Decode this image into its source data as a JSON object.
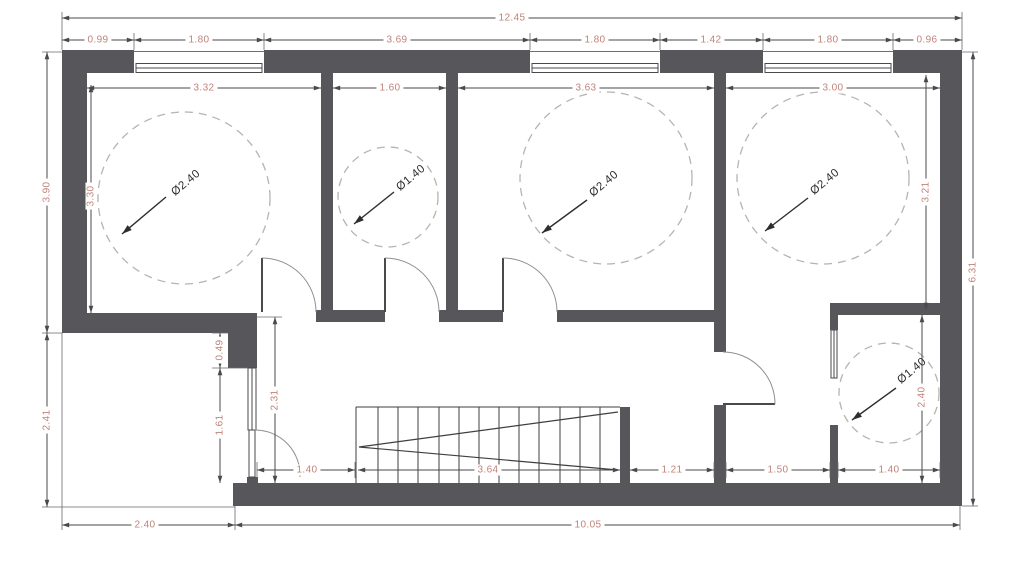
{
  "drawing_type": "architectural-floor-plan",
  "colors": {
    "wall": "#57565a",
    "line": "#4a4a4d",
    "dim_text": "#c0837a",
    "circle_dash": "#b7b3b0",
    "door_arc": "#8f8f8f",
    "background": "#ffffff"
  },
  "dims": {
    "overall_width": "12.45",
    "top": [
      "0.99",
      "1.80",
      "3.69",
      "1.80",
      "1.42",
      "1.80",
      "0.96"
    ],
    "left_upper": "3.90",
    "left_lower": "2.41",
    "right_height": "6.31",
    "bottom_left": "2.40",
    "bottom_right": "10.05",
    "room1_w": "3.32",
    "room1_h": "3.30",
    "room2_w": "1.60",
    "room3_w": "3.63",
    "room4_w": "3.00",
    "room4_h": "3.21",
    "entry_upper": "0.49",
    "entry_window": "1.61",
    "entry_clear": "2.31",
    "hall_left": "1.40",
    "stairs_run": "3.64",
    "hall_mid": "1.21",
    "lobby": "1.50",
    "bath_w": "1.40",
    "bath_h": "2.40"
  },
  "circles": {
    "room1": "Ø2.40",
    "room2": "Ø1.40",
    "room3": "Ø2.40",
    "room4": "Ø2.40",
    "bath": "Ø1.40"
  }
}
